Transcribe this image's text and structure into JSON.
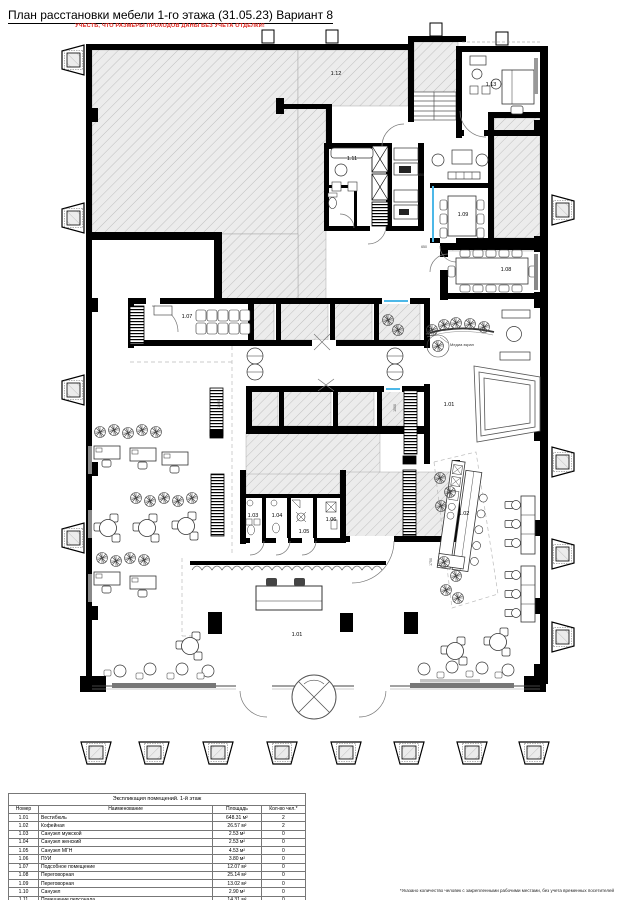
{
  "header": {
    "title": "План расстановки мебели 1-го этажа (31.05.23) Вариант 8",
    "warning": "УЧЕСТЬ, ЧТО РАЗМЕРЫ ПРОХОДОВ ДАНЫ БЕЗ УЧЕТА ОТДЕЛКИ!"
  },
  "plan": {
    "glass_color": "#4db8e8",
    "room_labels": [
      {
        "text": "1.12"
      },
      {
        "text": "1.13"
      },
      {
        "text": "1.11"
      },
      {
        "text": "1.09"
      },
      {
        "text": "1.08"
      },
      {
        "text": "1.07"
      },
      {
        "text": "1.01"
      },
      {
        "text": "1.02"
      },
      {
        "text": "1.03"
      },
      {
        "text": "1.04"
      },
      {
        "text": "1.05"
      },
      {
        "text": "1.06"
      },
      {
        "text": "1.01"
      }
    ],
    "annotations": [
      {
        "text": "Медиа экран"
      }
    ],
    "dimensions": [
      {
        "text": "650"
      },
      {
        "text": "650"
      },
      {
        "text": "1500"
      },
      {
        "text": "1500"
      },
      {
        "text": "1750"
      }
    ]
  },
  "explication": {
    "title": "Экспликация помещений. 1-й этаж",
    "columns": [
      "Номер",
      "Наименование",
      "Площадь",
      "Кол-во чел.*"
    ],
    "rows": [
      {
        "num": "1.01",
        "name": "Вестибюль",
        "area": "648.31 м²",
        "people": "2"
      },
      {
        "num": "1.02",
        "name": "Кофейная",
        "area": "26.57 м²",
        "people": "2"
      },
      {
        "num": "1.03",
        "name": "Санузел мужской",
        "area": "2.53 м²",
        "people": "0"
      },
      {
        "num": "1.04",
        "name": "Санузел женский",
        "area": "2.53 м²",
        "people": "0"
      },
      {
        "num": "1.05",
        "name": "Санузел МГН",
        "area": "4.53 м²",
        "people": "0"
      },
      {
        "num": "1.06",
        "name": "ПУИ",
        "area": "3.80 м²",
        "people": "0"
      },
      {
        "num": "1.07",
        "name": "Подсобное помещение",
        "area": "12.07 м²",
        "people": "0"
      },
      {
        "num": "1.08",
        "name": "Переговорная",
        "area": "25.14 м²",
        "people": "0"
      },
      {
        "num": "1.09",
        "name": "Переговорная",
        "area": "13.02 м²",
        "people": "0"
      },
      {
        "num": "1.10",
        "name": "Санузел",
        "area": "2.90 м²",
        "people": "0"
      },
      {
        "num": "1.11",
        "name": "Помещение персонала",
        "area": "14.31 м²",
        "people": "0"
      },
      {
        "num": "1.12",
        "name": "Помещение пожарного поста, диспетчерской, поста охраны и видеонаблюдения",
        "area": "29.29 м²",
        "people": "3"
      },
      {
        "num": "1.13",
        "name": "Помещение охраны",
        "area": "16.00 м²",
        "people": "2"
      }
    ],
    "total": {
      "area": "802.20 м²",
      "people": "9"
    }
  },
  "footnote": "*Указано количество человек с закрепленными рабочими местами, без учета временных посетителей"
}
